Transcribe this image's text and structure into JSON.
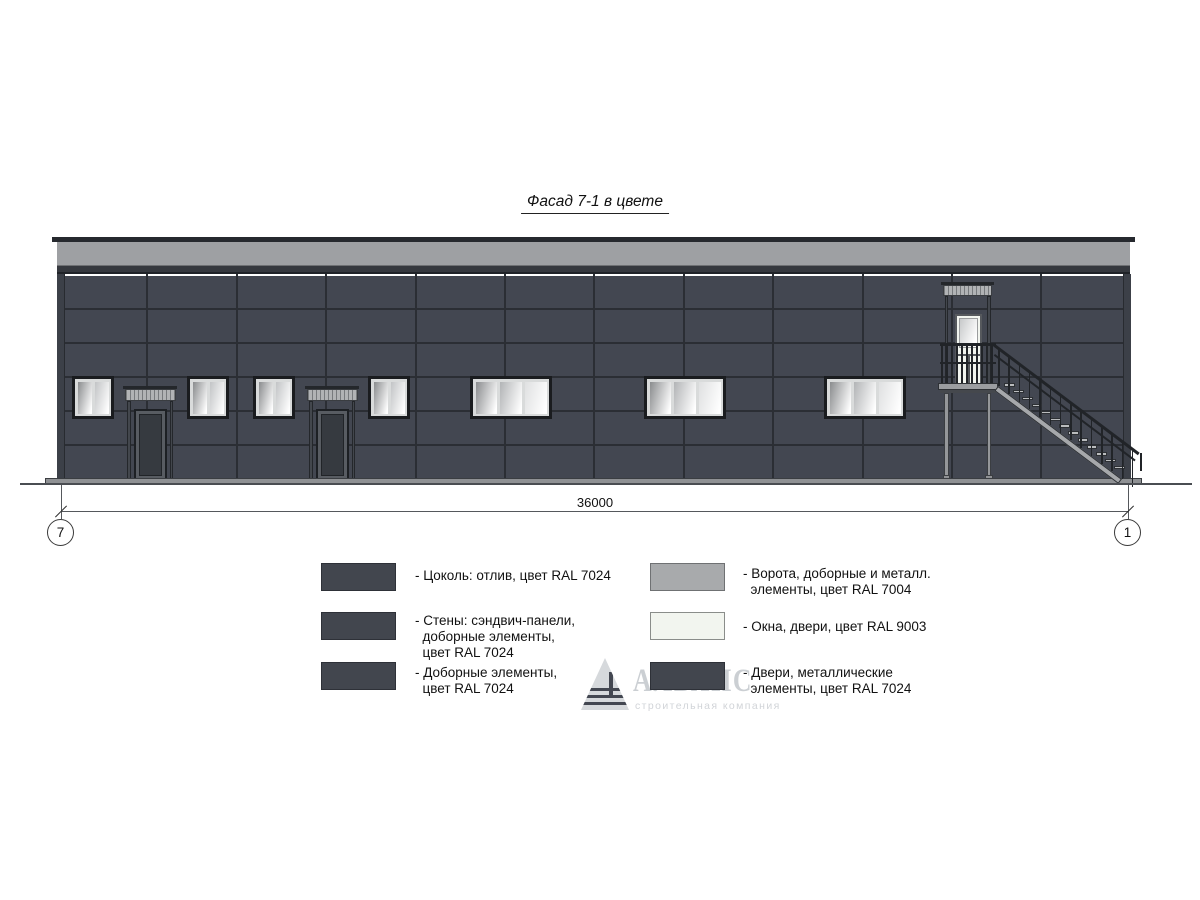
{
  "drawing": {
    "title": "Фасад 7-1 в цвете",
    "dimension_label": "36000",
    "axis_left": "7",
    "axis_right": "1"
  },
  "watermark": {
    "brand": "АЛЬЯНС",
    "tagline": "строительная компания"
  },
  "legend": {
    "left": [
      {
        "text": "- Цоколь: отлив, цвет RAL 7024"
      },
      {
        "text": "- Стены: сэндвич-панели,\n  доборные элементы,\n  цвет RAL 7024"
      },
      {
        "text": "- Доборные элементы,\n  цвет RAL 7024"
      }
    ],
    "right": [
      {
        "text": "- Ворота, доборные и металл.\n  элементы, цвет RAL 7004"
      },
      {
        "text": "- Окна, двери, цвет RAL 9003"
      },
      {
        "text": "- Двери, металлические\n  элементы, цвет RAL 7024"
      }
    ]
  },
  "colors": {
    "wall_ral7024": "#434751",
    "joint": "#2b2e34",
    "fascia_ral7004": "#9EA0A3",
    "plinth": "#8F9194",
    "window_ral9003": "#F2F5EF",
    "dark_metal_ral7024": "#42464E",
    "gate_ral7004": "#A8AAAC",
    "stair_gray": "#A6A8AB",
    "railing_dark": "#212428"
  }
}
